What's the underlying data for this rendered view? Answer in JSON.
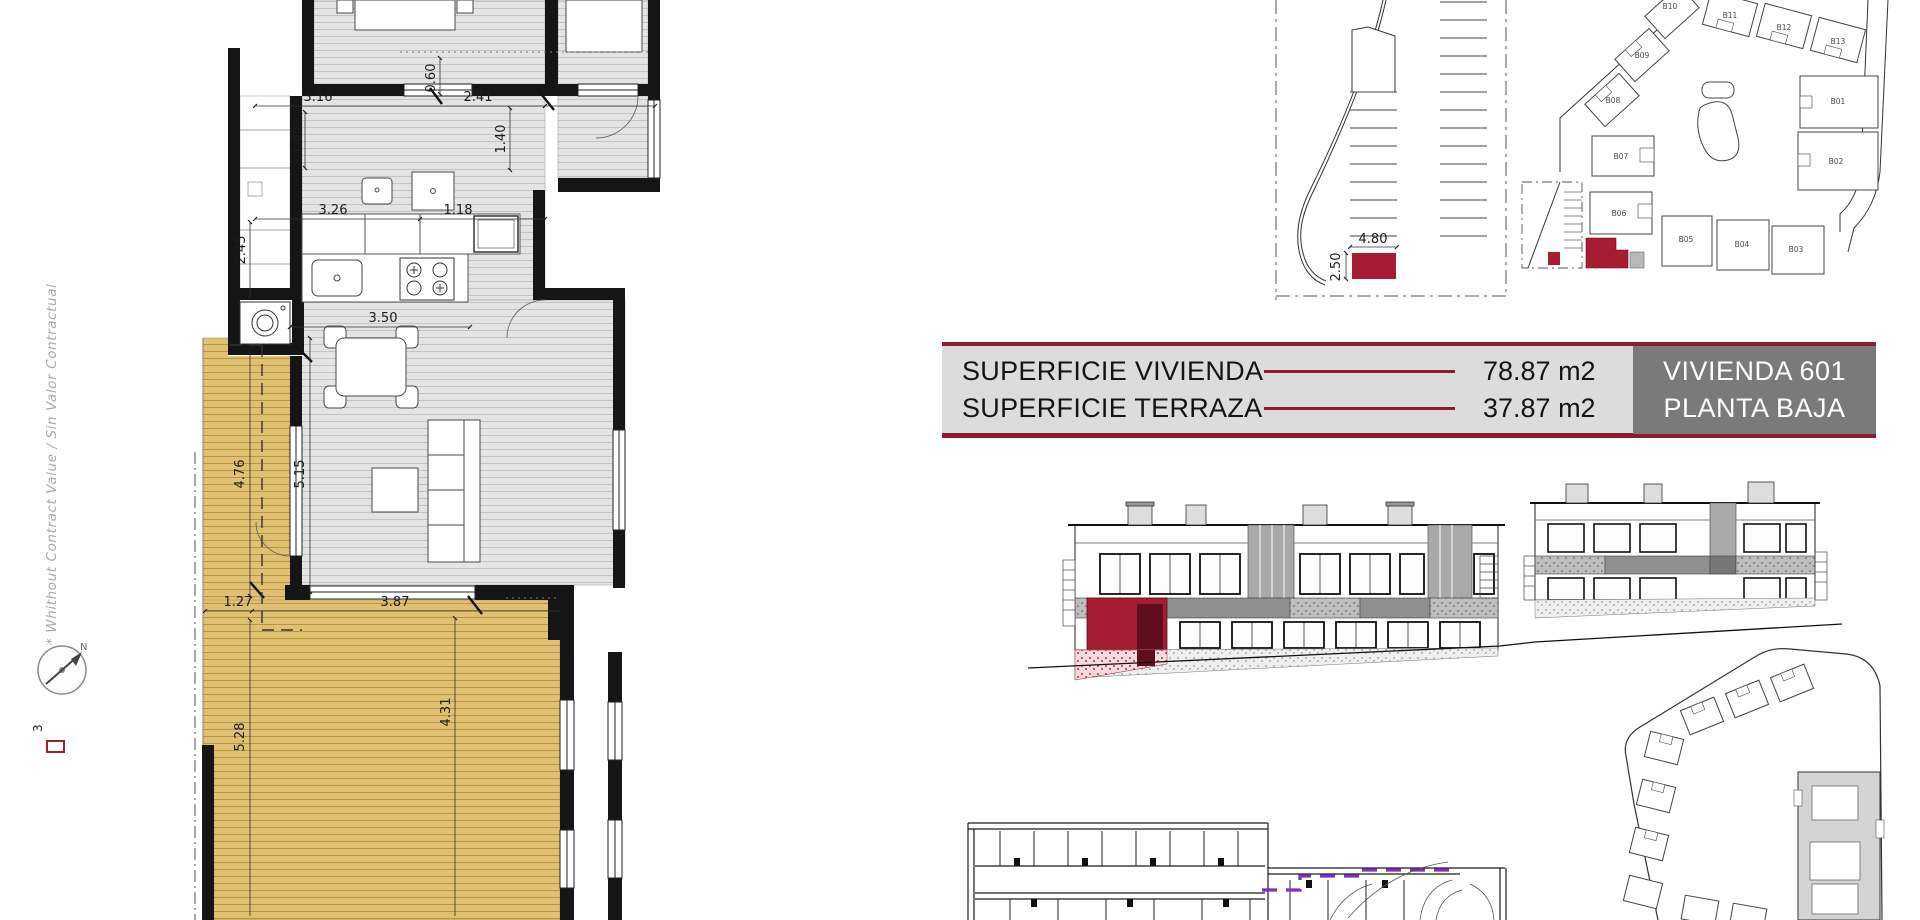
{
  "annotations": {
    "disclaimer_vertical": "* Whithout Contract Value / Sin Valor Contractual",
    "north_label": "N",
    "sheet_number": "3"
  },
  "title_block": {
    "rows": [
      {
        "label": "SUPERFICIE VIVIENDA",
        "value": "78.87 m2"
      },
      {
        "label": "SUPERFICIE TERRAZA",
        "value": "37.87 m2"
      }
    ],
    "unit_name": "VIVIENDA 601",
    "unit_floor": "PLANTA BAJA"
  },
  "floor_plan": {
    "dimensions": [
      "3.16",
      "2.41",
      "0.60",
      "1.55",
      "1.40",
      "3.26",
      "1.18",
      "2.45",
      "3.50",
      "4.76",
      "5.15",
      "1.27",
      "3.87",
      "5.28",
      "4.31"
    ]
  },
  "parking_plan": {
    "dimensions": {
      "width": "4.80",
      "depth": "2.50"
    }
  },
  "site_plan": {
    "buildings": [
      "B01",
      "B02",
      "B03",
      "B04",
      "B05",
      "B06",
      "B07",
      "B08",
      "B09",
      "B10",
      "B11",
      "B12",
      "B13"
    ]
  },
  "colors": {
    "highlight": "#A51C33",
    "accent": "#8E1B2E",
    "terrace_hatch": "#DFBE6C",
    "floor_hatch": "#E3E3E3",
    "title_panel_bg": "#DCDCDC",
    "unit_panel_bg": "#7A7A7A",
    "unit_panel_text": "#FFFFFF"
  }
}
